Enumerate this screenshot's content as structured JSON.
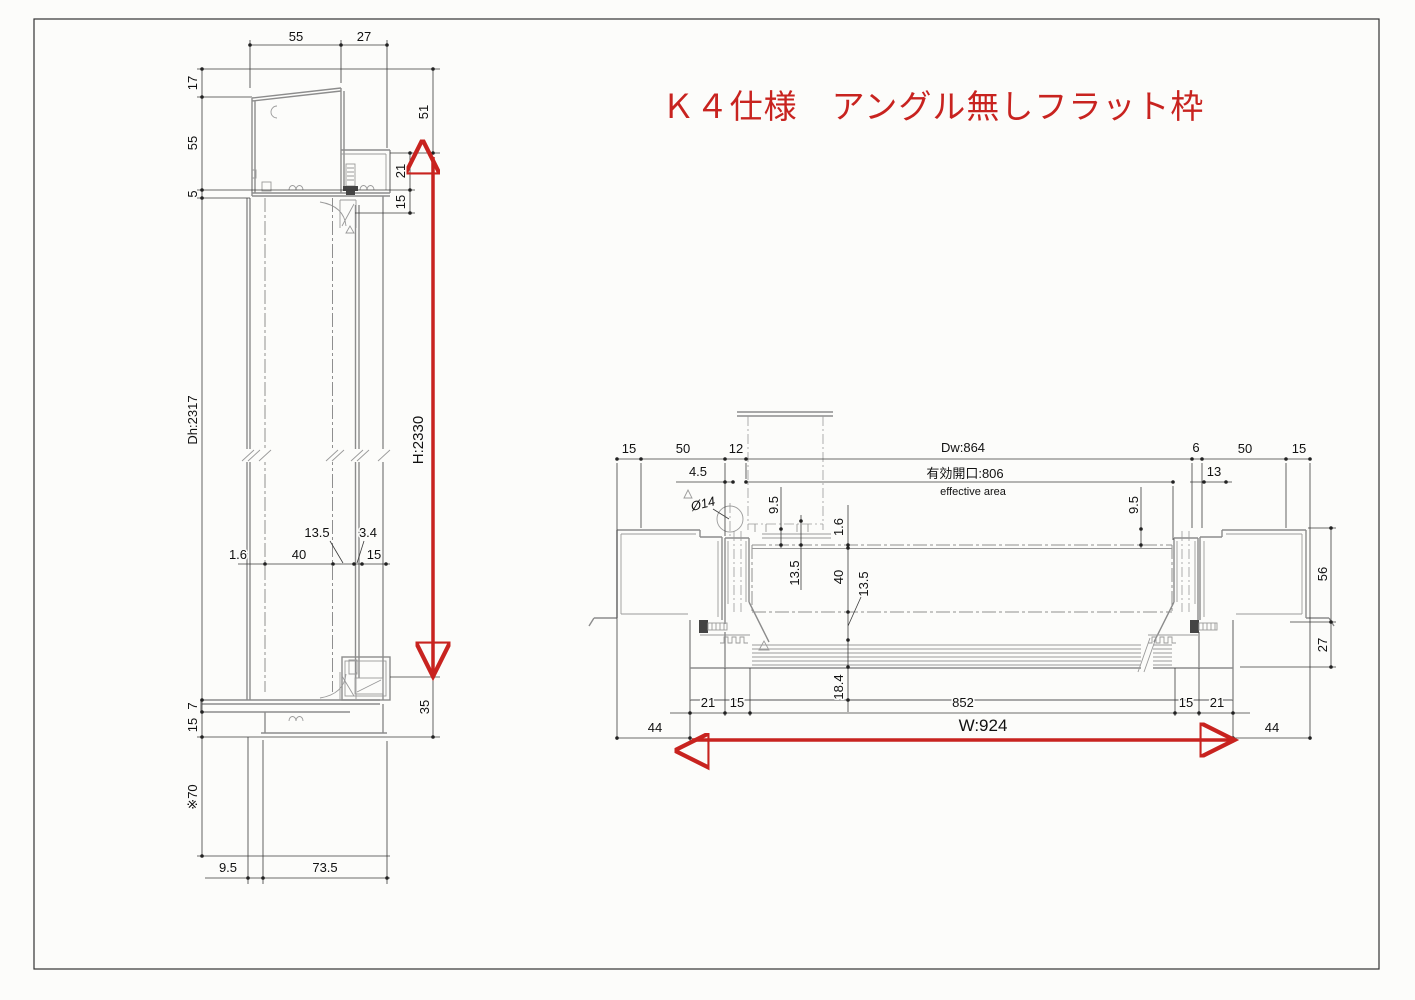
{
  "title": {
    "text": "Ｋ４仕様　アングル無しフラット枠"
  },
  "colors": {
    "accent_red": "#c8231f",
    "profile_gray": "#8c8c8c",
    "dim_black": "#111111",
    "background": "#fcfcfa"
  },
  "left_view": {
    "name": "vertical-section",
    "dims": {
      "top_55": "55",
      "top_27": "27",
      "left_17": "17",
      "left_55": "55",
      "left_5": "5",
      "left_dh": "Dh:2317",
      "left_7": "7",
      "left_15": "15",
      "left_note70": "※70",
      "bottom_9_5": "9.5",
      "bottom_73_5": "73.5",
      "right_51": "51",
      "right_21": "21",
      "right_15": "15",
      "right_35": "35",
      "height_red": "H:2330",
      "mid_1_6": "1.6",
      "mid_40": "40",
      "mid_13_5": "13.5",
      "mid_3_4": "3.4",
      "mid_15": "15"
    }
  },
  "right_view": {
    "name": "horizontal-section",
    "dims": {
      "top_15_left": "15",
      "top_50_left": "50",
      "top_12": "12",
      "top_dw": "Dw:864",
      "top_6": "6",
      "top_50_right": "50",
      "top_15_right": "15",
      "opening_jp": "有効開口:806",
      "opening_en": "effective area",
      "d_4_5": "4.5",
      "d_phi14": "Ø14",
      "d_9_5_left": "9.5",
      "d_9_5_right": "9.5",
      "d_13": "13",
      "d_1_6": "1.6",
      "d_13_5_upper": "13.5",
      "d_40": "40",
      "d_13_5_lower": "13.5",
      "d_18_4": "18.4",
      "right_56": "56",
      "right_27": "27",
      "bottom_21_left": "21",
      "bottom_15_left": "15",
      "bottom_852": "852",
      "bottom_15_right": "15",
      "bottom_21_right": "21",
      "bottom_44_left": "44",
      "bottom_44_right": "44",
      "width_red": "W:924"
    }
  }
}
